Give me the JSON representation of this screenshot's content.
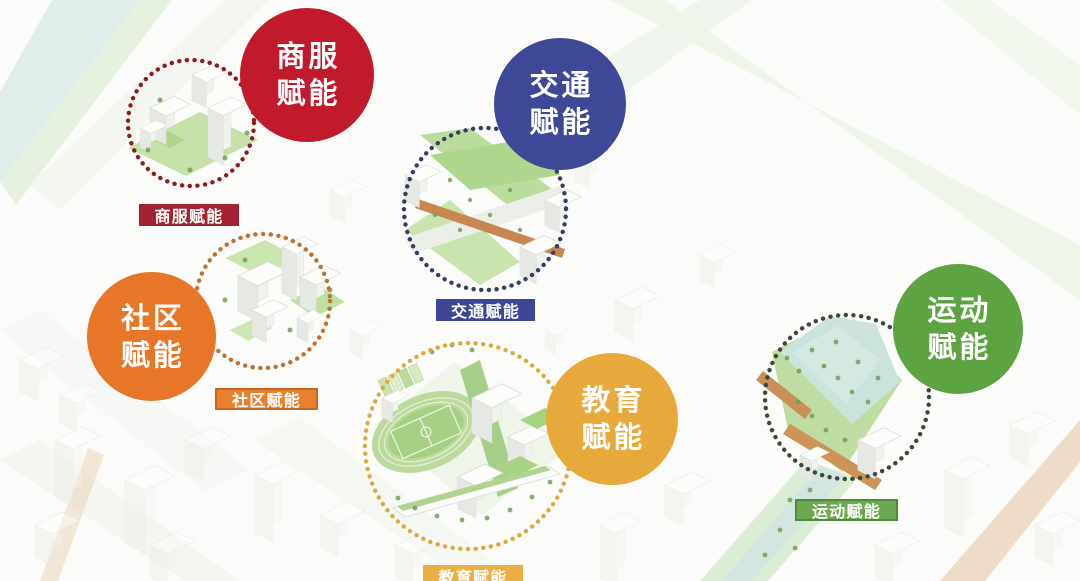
{
  "zones": [
    {
      "id": "commerce-service",
      "bubble_line1": "商服",
      "bubble_line2": "赋能",
      "tag_label": "商服赋能",
      "colors": {
        "bubble": "#c01a2c",
        "tag_bg": "#a32330",
        "tag_text": "#ffffff",
        "dots": "#8e1b1f"
      }
    },
    {
      "id": "traffic",
      "bubble_line1": "交通",
      "bubble_line2": "赋能",
      "tag_label": "交通赋能",
      "colors": {
        "bubble": "#3f4897",
        "tag_bg": "#3d4795",
        "tag_text": "#ffffff",
        "dots": "#353e63"
      }
    },
    {
      "id": "community",
      "bubble_line1": "社区",
      "bubble_line2": "赋能",
      "tag_label": "社区赋能",
      "colors": {
        "bubble": "#e87629",
        "tag_bg": "#e8802e",
        "tag_text": "#ffffff",
        "dots": "#c2702f"
      }
    },
    {
      "id": "education",
      "bubble_line1": "教育",
      "bubble_line2": "赋能",
      "tag_label": "教育赋能",
      "colors": {
        "bubble": "#e7a93c",
        "tag_bg": "#ebae45",
        "tag_text": "#ffffff",
        "dots": "#dda93f"
      }
    },
    {
      "id": "sports",
      "bubble_line1": "运动",
      "bubble_line2": "赋能",
      "tag_label": "运动赋能",
      "colors": {
        "bubble": "#5da342",
        "tag_bg": "#6ca751",
        "tag_text": "#ffffff",
        "dots": "#3f463c"
      }
    }
  ]
}
